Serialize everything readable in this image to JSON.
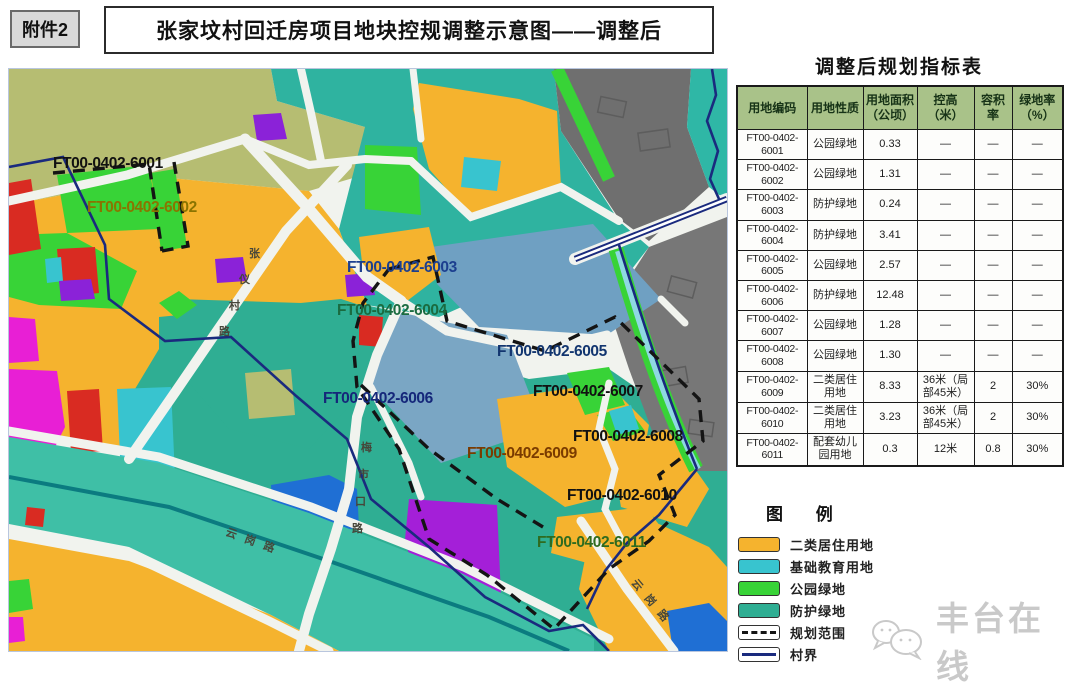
{
  "page": {
    "attachment_label": "附件2",
    "title": "张家坟村回迁房项目地块控规调整示意图——调整后"
  },
  "table": {
    "title": "调整后规划指标表",
    "headers": [
      "用地编码",
      "用地性质",
      "用地面积（公顷）",
      "控高（米）",
      "容积率",
      "绿地率（%）"
    ],
    "rows": [
      {
        "code_line1": "FT00-0402-",
        "code_line2": "6001",
        "use": "公园绿地",
        "area": "0.33",
        "height": "—",
        "far": "—",
        "green": "—"
      },
      {
        "code_line1": "FT00-0402-",
        "code_line2": "6002",
        "use": "公园绿地",
        "area": "1.31",
        "height": "—",
        "far": "—",
        "green": "—"
      },
      {
        "code_line1": "FT00-0402-",
        "code_line2": "6003",
        "use": "防护绿地",
        "area": "0.24",
        "height": "—",
        "far": "—",
        "green": "—"
      },
      {
        "code_line1": "FT00-0402-",
        "code_line2": "6004",
        "use": "防护绿地",
        "area": "3.41",
        "height": "—",
        "far": "—",
        "green": "—"
      },
      {
        "code_line1": "FT00-0402-",
        "code_line2": "6005",
        "use": "公园绿地",
        "area": "2.57",
        "height": "—",
        "far": "—",
        "green": "—"
      },
      {
        "code_line1": "FT00-0402-",
        "code_line2": "6006",
        "use": "防护绿地",
        "area": "12.48",
        "height": "—",
        "far": "—",
        "green": "—"
      },
      {
        "code_line1": "FT00-0402-",
        "code_line2": "6007",
        "use": "公园绿地",
        "area": "1.28",
        "height": "—",
        "far": "—",
        "green": "—"
      },
      {
        "code_line1": "FT00-0402-",
        "code_line2": "6008",
        "use": "公园绿地",
        "area": "1.30",
        "height": "—",
        "far": "—",
        "green": "—"
      },
      {
        "code_line1": "FT00-0402-",
        "code_line2": "6009",
        "use": "二类居住用地",
        "area": "8.33",
        "height": "36米（局部45米）",
        "far": "2",
        "green": "30%"
      },
      {
        "code_line1": "FT00-0402-",
        "code_line2": "6010",
        "use": "二类居住用地",
        "area": "3.23",
        "height": "36米（局部45米）",
        "far": "2",
        "green": "30%"
      },
      {
        "code_line1": "FT00-0402-",
        "code_line2": "6011",
        "use": "配套幼儿园用地",
        "area": "0.3",
        "height": "12米",
        "far": "0.8",
        "green": "30%"
      }
    ]
  },
  "legend": {
    "title": "图  例",
    "items": [
      {
        "label": "二类居住用地",
        "type": "swatch",
        "color": "#f5b32e",
        "icon": "residential-swatch"
      },
      {
        "label": "基础教育用地",
        "type": "swatch",
        "color": "#38c4cf",
        "icon": "education-swatch"
      },
      {
        "label": "公园绿地",
        "type": "swatch",
        "color": "#38d337",
        "icon": "park-green-swatch"
      },
      {
        "label": "防护绿地",
        "type": "swatch",
        "color": "#2fae93",
        "icon": "buffer-green-swatch"
      },
      {
        "label": "规划范围",
        "type": "line",
        "line": "3px dashed #141414",
        "icon": "planning-boundary-line"
      },
      {
        "label": "村界",
        "type": "line",
        "line": "3px solid #1a2a7e",
        "icon": "village-border-line"
      }
    ]
  },
  "map": {
    "labels": [
      {
        "text": "FT00-0402-6001",
        "color": "#111111"
      },
      {
        "text": "FT00-0402-6002",
        "color": "#8a7400"
      },
      {
        "text": "FT00-0402-6003",
        "color": "#1c3f8f"
      },
      {
        "text": "FT00-0402-6004",
        "color": "#1a6b40"
      },
      {
        "text": "FT00-0402-6005",
        "color": "#12356f"
      },
      {
        "text": "FT00-0402-6006",
        "color": "#15277a"
      },
      {
        "text": "FT00-0402-6007",
        "color": "#111111"
      },
      {
        "text": "FT00-0402-6008",
        "color": "#111111"
      },
      {
        "text": "FT00-0402-6009",
        "color": "#7a3b00"
      },
      {
        "text": "FT00-0402-6010",
        "color": "#111111"
      },
      {
        "text": "FT00-0402-6011",
        "color": "#2f6b1f"
      }
    ],
    "road_labels": [
      {
        "text": "张仪村路"
      },
      {
        "text": "梅市口路"
      },
      {
        "text": "云岗路"
      },
      {
        "text": "云岗路"
      }
    ]
  },
  "watermark": {
    "text": "丰台在线"
  },
  "colors": {
    "residential_orange": "#f5b32e",
    "education_cyan": "#38c4cf",
    "park_green": "#38d337",
    "buffer_teal": "#2fae93",
    "steel_blue": "#6fa0c2",
    "built_gray": "#6f6f6f",
    "olive": "#b6bd72",
    "road_white": "#f1f3ee",
    "village_navy": "#1a2a7e",
    "canal_teal": "#0b7b80",
    "table_header_green": "#a9c289"
  }
}
